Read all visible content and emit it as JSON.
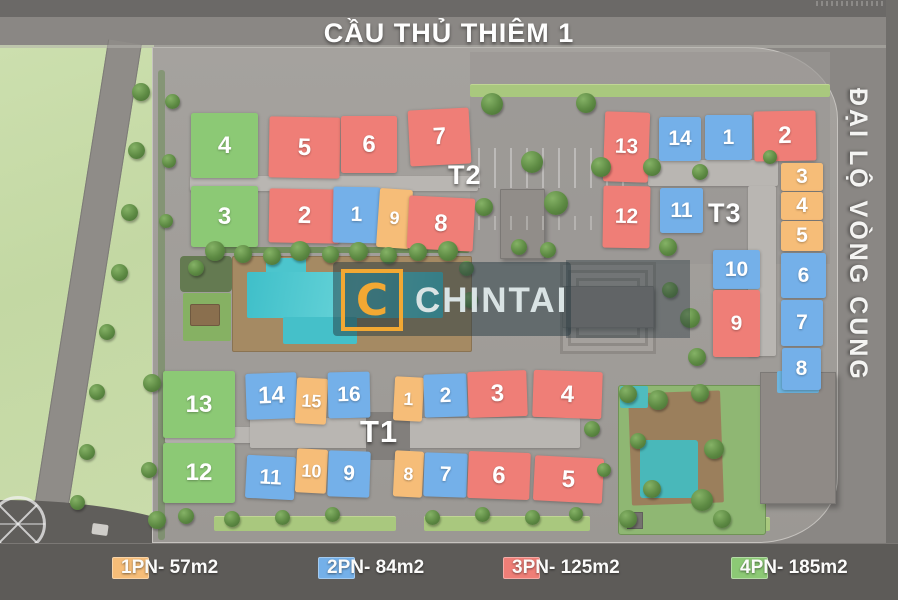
{
  "title": "CẦU THỦ THIÊM 1",
  "right_road_label": "ĐẠI LỘ VÒNG CUNG",
  "watermark": {
    "letter": "C",
    "name": "CHINTAI"
  },
  "legend": [
    {
      "type": "1PN",
      "label": "1PN- 57m2",
      "color": "#F6BD78"
    },
    {
      "type": "2PN",
      "label": "2PN- 84m2",
      "color": "#74B0E9"
    },
    {
      "type": "3PN",
      "label": "3PN- 125m2",
      "color": "#EF7E77"
    },
    {
      "type": "4PN",
      "label": "4PN- 185m2",
      "color": "#8CC975"
    }
  ],
  "towers": [
    {
      "id": "T2",
      "label": "T2",
      "label_pos": {
        "x": 448,
        "y": 160,
        "size": 27
      },
      "blocks": [
        {
          "no": "4",
          "type": "4PN",
          "x": 191,
          "y": 113,
          "w": 67,
          "h": 65,
          "r": 0
        },
        {
          "no": "5",
          "type": "3PN",
          "x": 269,
          "y": 117,
          "w": 71,
          "h": 61,
          "r": 1
        },
        {
          "no": "6",
          "type": "3PN",
          "x": 341,
          "y": 116,
          "w": 56,
          "h": 57,
          "r": 0
        },
        {
          "no": "7",
          "type": "3PN",
          "x": 409,
          "y": 109,
          "w": 61,
          "h": 56,
          "r": -3
        },
        {
          "no": "3",
          "type": "4PN",
          "x": 191,
          "y": 186,
          "w": 67,
          "h": 61,
          "r": 0
        },
        {
          "no": "2",
          "type": "3PN",
          "x": 269,
          "y": 189,
          "w": 71,
          "h": 54,
          "r": 1
        },
        {
          "no": "1",
          "type": "2PN",
          "x": 333,
          "y": 187,
          "w": 47,
          "h": 56,
          "r": 1
        },
        {
          "no": "9",
          "type": "1PN",
          "x": 378,
          "y": 189,
          "w": 33,
          "h": 59,
          "r": 4
        },
        {
          "no": "8",
          "type": "3PN",
          "x": 408,
          "y": 197,
          "w": 66,
          "h": 53,
          "r": 3
        }
      ]
    },
    {
      "id": "T3",
      "label": "T3",
      "label_pos": {
        "x": 708,
        "y": 198,
        "size": 27
      },
      "blocks": [
        {
          "no": "13",
          "type": "3PN",
          "x": 604,
          "y": 112,
          "w": 45,
          "h": 70,
          "r": 2
        },
        {
          "no": "14",
          "type": "2PN",
          "x": 659,
          "y": 117,
          "w": 42,
          "h": 44,
          "r": 0
        },
        {
          "no": "1",
          "type": "2PN",
          "x": 705,
          "y": 115,
          "w": 47,
          "h": 45,
          "r": 0
        },
        {
          "no": "2",
          "type": "3PN",
          "x": 754,
          "y": 111,
          "w": 62,
          "h": 50,
          "r": -1
        },
        {
          "no": "12",
          "type": "3PN",
          "x": 603,
          "y": 186,
          "w": 47,
          "h": 62,
          "r": 1
        },
        {
          "no": "11",
          "type": "2PN",
          "x": 660,
          "y": 188,
          "w": 43,
          "h": 45,
          "r": 0
        },
        {
          "no": "3",
          "type": "1PN",
          "x": 781,
          "y": 163,
          "w": 42,
          "h": 28,
          "r": 0
        },
        {
          "no": "4",
          "type": "1PN",
          "x": 781,
          "y": 192,
          "w": 42,
          "h": 28,
          "r": 0
        },
        {
          "no": "5",
          "type": "1PN",
          "x": 781,
          "y": 221,
          "w": 42,
          "h": 30,
          "r": 0
        },
        {
          "no": "6",
          "type": "2PN",
          "x": 781,
          "y": 253,
          "w": 45,
          "h": 45,
          "r": 0
        },
        {
          "no": "7",
          "type": "2PN",
          "x": 781,
          "y": 300,
          "w": 42,
          "h": 46,
          "r": 0
        },
        {
          "no": "8",
          "type": "2PN",
          "x": 782,
          "y": 348,
          "w": 39,
          "h": 42,
          "r": 0
        },
        {
          "no": "10",
          "type": "2PN",
          "x": 713,
          "y": 250,
          "w": 47,
          "h": 39,
          "r": 0
        },
        {
          "no": "9",
          "type": "3PN",
          "x": 713,
          "y": 290,
          "w": 47,
          "h": 67,
          "r": 0
        }
      ]
    },
    {
      "id": "T1",
      "label": "T1",
      "label_pos": {
        "x": 360,
        "y": 414,
        "size": 31
      },
      "blocks": [
        {
          "no": "13",
          "type": "4PN",
          "x": 163,
          "y": 371,
          "w": 72,
          "h": 67,
          "r": 0
        },
        {
          "no": "14",
          "type": "2PN",
          "x": 246,
          "y": 373,
          "w": 51,
          "h": 46,
          "r": -2
        },
        {
          "no": "15",
          "type": "1PN",
          "x": 296,
          "y": 378,
          "w": 31,
          "h": 46,
          "r": 3
        },
        {
          "no": "16",
          "type": "2PN",
          "x": 328,
          "y": 372,
          "w": 42,
          "h": 46,
          "r": -1
        },
        {
          "no": "1",
          "type": "1PN",
          "x": 394,
          "y": 377,
          "w": 29,
          "h": 44,
          "r": 3
        },
        {
          "no": "2",
          "type": "2PN",
          "x": 424,
          "y": 374,
          "w": 43,
          "h": 43,
          "r": -2
        },
        {
          "no": "3",
          "type": "3PN",
          "x": 468,
          "y": 371,
          "w": 59,
          "h": 46,
          "r": -2
        },
        {
          "no": "4",
          "type": "3PN",
          "x": 533,
          "y": 371,
          "w": 69,
          "h": 47,
          "r": 2
        },
        {
          "no": "12",
          "type": "4PN",
          "x": 163,
          "y": 443,
          "w": 72,
          "h": 60,
          "r": 0
        },
        {
          "no": "11",
          "type": "2PN",
          "x": 246,
          "y": 456,
          "w": 49,
          "h": 43,
          "r": 3
        },
        {
          "no": "10",
          "type": "1PN",
          "x": 296,
          "y": 449,
          "w": 31,
          "h": 44,
          "r": 3
        },
        {
          "no": "9",
          "type": "2PN",
          "x": 328,
          "y": 451,
          "w": 42,
          "h": 46,
          "r": 2
        },
        {
          "no": "8",
          "type": "1PN",
          "x": 394,
          "y": 451,
          "w": 29,
          "h": 46,
          "r": 3
        },
        {
          "no": "7",
          "type": "2PN",
          "x": 424,
          "y": 453,
          "w": 43,
          "h": 44,
          "r": 2
        },
        {
          "no": "6",
          "type": "3PN",
          "x": 468,
          "y": 452,
          "w": 62,
          "h": 47,
          "r": 2
        },
        {
          "no": "5",
          "type": "3PN",
          "x": 534,
          "y": 457,
          "w": 69,
          "h": 45,
          "r": 3
        }
      ]
    }
  ]
}
